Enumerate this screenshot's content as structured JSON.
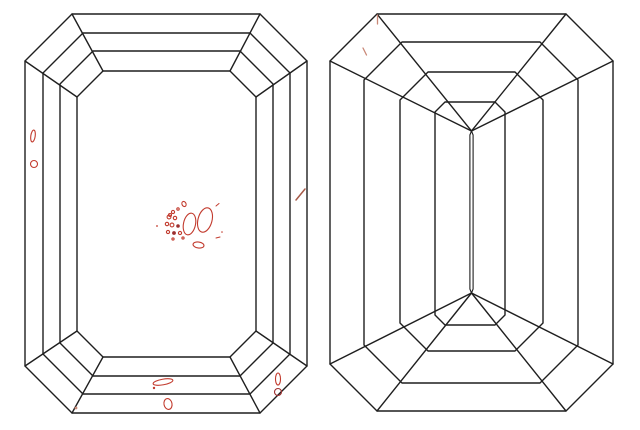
{
  "page": {
    "background": "#ffffff",
    "width": 640,
    "height": 430
  },
  "colors": {
    "outline": "#1f1f1f",
    "inclusion": "#c23b2e",
    "inclusion_dark": "#9c2f2f",
    "inclusion_faint": "#c98877",
    "inclusion_brown": "#a65a48"
  },
  "stroke_widths": {
    "outline": 1.4,
    "inclusion": 1.1
  },
  "chart_data": {
    "type": "diagram",
    "title": "",
    "description_of_pixels": "Two emerald-cut diamond outline views side by side with red inclusion marks",
    "views": [
      "crown-view",
      "pavilion-view"
    ]
  },
  "diagrams": [
    {
      "id": "crown-view",
      "corner_mode": "table",
      "rings": [
        [
          25,
          14,
          307,
          413,
          47
        ],
        [
          43,
          33,
          290,
          394,
          40
        ],
        [
          60,
          51,
          273,
          376,
          33
        ],
        [
          77,
          71,
          256,
          357,
          26
        ]
      ],
      "inclusions": [
        {
          "shape": "ellipse",
          "cx": 33,
          "cy": 136,
          "rx": 2.2,
          "ry": 6,
          "rot": 8,
          "tone": "normal"
        },
        {
          "shape": "circle",
          "cx": 34,
          "cy": 164,
          "r": 3.5,
          "tone": "normal"
        },
        {
          "shape": "line",
          "x1": 296,
          "y1": 200,
          "x2": 305,
          "y2": 189,
          "tone": "brown",
          "w": 1.5
        },
        {
          "shape": "ellipse",
          "cx": 205,
          "cy": 220,
          "rx": 7,
          "ry": 12.5,
          "rot": 15,
          "tone": "normal"
        },
        {
          "shape": "ellipse",
          "cx": 189.5,
          "cy": 224,
          "rx": 6,
          "ry": 11,
          "rot": 12,
          "tone": "normal"
        },
        {
          "shape": "ellipse",
          "cx": 198.5,
          "cy": 245,
          "rx": 5.5,
          "ry": 3,
          "rot": 8,
          "tone": "normal"
        },
        {
          "shape": "ellipse",
          "cx": 184,
          "cy": 204,
          "rx": 2,
          "ry": 2.6,
          "rot": -25,
          "tone": "normal"
        },
        {
          "shape": "circle",
          "cx": 173,
          "cy": 212,
          "r": 1.6,
          "tone": "normal"
        },
        {
          "shape": "circle",
          "cx": 178,
          "cy": 209,
          "r": 1.2,
          "tone": "normal"
        },
        {
          "shape": "circle",
          "cx": 170,
          "cy": 215,
          "r": 1.5,
          "tone": "normal"
        },
        {
          "shape": "circle",
          "cx": 169,
          "cy": 217,
          "r": 1.9,
          "tone": "normal"
        },
        {
          "shape": "circle",
          "cx": 175,
          "cy": 218,
          "r": 1.7,
          "tone": "normal"
        },
        {
          "shape": "circle",
          "cx": 167,
          "cy": 224,
          "r": 1.7,
          "tone": "normal"
        },
        {
          "shape": "circle",
          "cx": 172,
          "cy": 225,
          "r": 1.9,
          "tone": "normal"
        },
        {
          "shape": "circle",
          "cx": 168,
          "cy": 232,
          "r": 1.6,
          "tone": "normal"
        },
        {
          "shape": "circle",
          "cx": 180,
          "cy": 233,
          "r": 1.6,
          "tone": "normal"
        },
        {
          "shape": "circle",
          "cx": 183,
          "cy": 238,
          "r": 1.1,
          "tone": "normal"
        },
        {
          "shape": "circle",
          "cx": 173,
          "cy": 239,
          "r": 1.1,
          "tone": "normal"
        },
        {
          "shape": "dot",
          "cx": 178,
          "cy": 226,
          "r": 1.8,
          "tone": "dark"
        },
        {
          "shape": "dot",
          "cx": 174,
          "cy": 233,
          "r": 1.9,
          "tone": "dark"
        },
        {
          "shape": "dot",
          "cx": 157,
          "cy": 226,
          "r": 0.9,
          "tone": "normal"
        },
        {
          "shape": "line",
          "x1": 216,
          "y1": 206,
          "x2": 219,
          "y2": 203.5,
          "tone": "normal",
          "w": 1
        },
        {
          "shape": "dot",
          "cx": 222,
          "cy": 232,
          "r": 0.8,
          "tone": "normal"
        },
        {
          "shape": "line",
          "x1": 216,
          "y1": 238,
          "x2": 220,
          "y2": 237,
          "tone": "normal",
          "w": 1
        },
        {
          "shape": "ellipse",
          "cx": 163,
          "cy": 382,
          "rx": 10,
          "ry": 2.8,
          "rot": -10,
          "tone": "normal"
        },
        {
          "shape": "dot",
          "cx": 154,
          "cy": 388,
          "r": 1.2,
          "tone": "normal"
        },
        {
          "shape": "ellipse",
          "cx": 168,
          "cy": 404,
          "rx": 4,
          "ry": 5.5,
          "rot": -12,
          "tone": "normal"
        },
        {
          "shape": "ellipse",
          "cx": 278,
          "cy": 379,
          "rx": 2.5,
          "ry": 6,
          "rot": 0,
          "tone": "normal"
        },
        {
          "shape": "circle",
          "cx": 278,
          "cy": 392,
          "r": 3.5,
          "tone": "dark"
        },
        {
          "shape": "dot",
          "cx": 76,
          "cy": 408,
          "r": 1.4,
          "tone": "faint"
        }
      ]
    },
    {
      "id": "pavilion-view",
      "corner_mode": "keel",
      "rings": [
        [
          330,
          14,
          613,
          411,
          47
        ],
        [
          364,
          42,
          578,
          383,
          38
        ],
        [
          400,
          72,
          543,
          351,
          28
        ],
        [
          435,
          102,
          505,
          325,
          10
        ]
      ],
      "keel": {
        "top": [
          471.5,
          131
        ],
        "bottom": [
          471.5,
          293
        ],
        "half_width": 1.6
      },
      "inclusions": [
        {
          "shape": "line",
          "x1": 377.5,
          "y1": 15,
          "x2": 377.5,
          "y2": 24,
          "tone": "faint",
          "w": 1.3
        },
        {
          "shape": "line",
          "x1": 363,
          "y1": 48,
          "x2": 366.5,
          "y2": 55,
          "tone": "faint",
          "w": 1.3
        }
      ]
    }
  ]
}
